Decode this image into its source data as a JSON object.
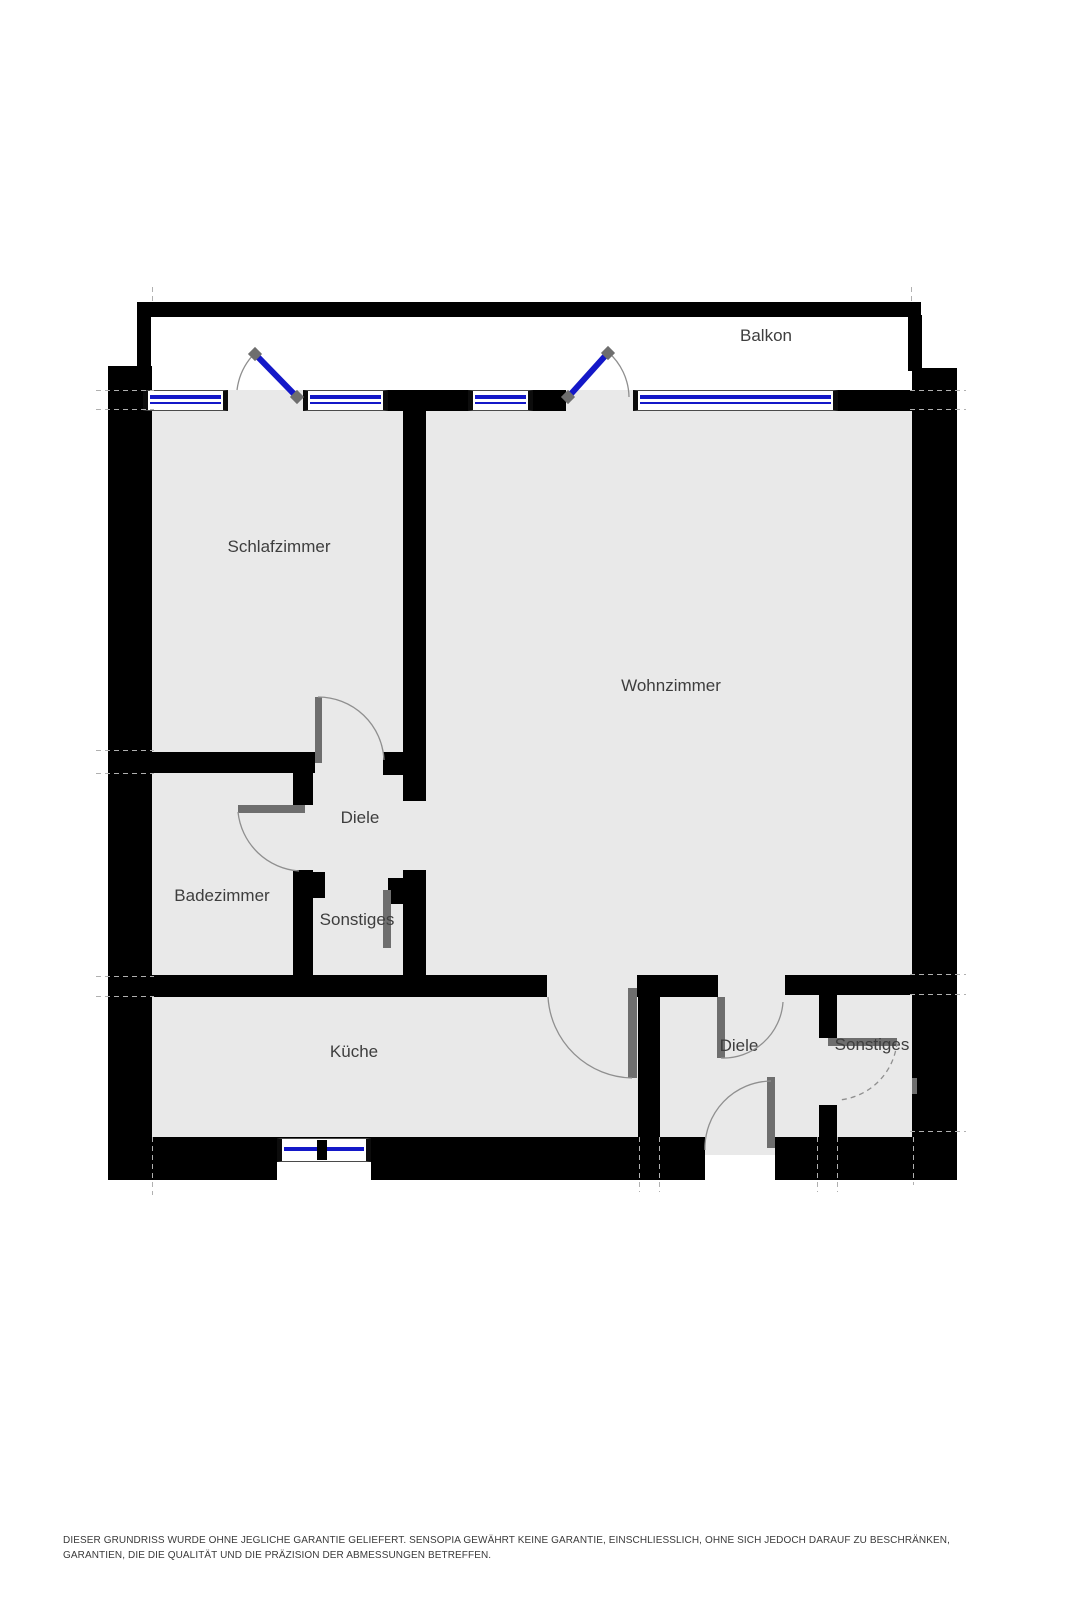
{
  "colors": {
    "wall": "#000000",
    "floor": "#e9e9e9",
    "window": "#1418c8",
    "leaf": "#6e6e6e",
    "arc": "#8f8f8f",
    "dash": "#b0b0b0",
    "label": "#3e3e3e",
    "disclaimer": "#3a3a3a"
  },
  "rooms": [
    {
      "name": "Balkon",
      "x": 766,
      "y": 336
    },
    {
      "name": "Schlafzimmer",
      "x": 279,
      "y": 547
    },
    {
      "name": "Wohnzimmer",
      "x": 671,
      "y": 686
    },
    {
      "name": "Diele",
      "x": 360,
      "y": 818
    },
    {
      "name": "Badezimmer",
      "x": 222,
      "y": 896
    },
    {
      "name": "Sonstiges",
      "x": 357,
      "y": 920
    },
    {
      "name": "Küche",
      "x": 354,
      "y": 1052
    },
    {
      "name": "Diele",
      "x": 739,
      "y": 1046
    },
    {
      "name": "Sonstiges",
      "x": 872,
      "y": 1045
    }
  ],
  "disclaimer": "DIESER GRUNDRISS WURDE OHNE JEGLICHE GARANTIE GELIEFERT. SENSOPIA GEWÄHRT KEINE GARANTIE, EINSCHLIESSLICH, OHNE SICH JEDOCH DARAUF ZU BESCHRÄNKEN, GARANTIEN, DIE DIE QUALITÄT UND DIE PRÄZISION DER ABMESSUNGEN BETREFFEN.",
  "plan": {
    "rects": [
      {
        "x": 151,
        "y": 390,
        "w": 762,
        "h": 747,
        "cls": "floor",
        "name": "apartment-floor"
      },
      {
        "x": 705,
        "y": 1137,
        "w": 70,
        "h": 18,
        "cls": "floor",
        "name": "entrance-floor-tongue"
      },
      {
        "x": 137,
        "y": 302,
        "w": 784,
        "h": 15,
        "cls": "wall",
        "name": "balcony-top-wall"
      },
      {
        "x": 137,
        "y": 315,
        "w": 14,
        "h": 78,
        "cls": "wall",
        "name": "balcony-left-wall"
      },
      {
        "x": 908,
        "y": 315,
        "w": 14,
        "h": 56,
        "cls": "wall",
        "name": "balcony-right-wall"
      },
      {
        "x": 108,
        "y": 366,
        "w": 44,
        "h": 814,
        "cls": "wall",
        "name": "left-outer-wall"
      },
      {
        "x": 912,
        "y": 368,
        "w": 45,
        "h": 812,
        "cls": "wall",
        "name": "right-outer-wall"
      },
      {
        "x": 388,
        "y": 390,
        "w": 80,
        "h": 21,
        "cls": "wall",
        "name": "window-pier-center"
      },
      {
        "x": 533,
        "y": 390,
        "w": 33,
        "h": 21,
        "cls": "wall",
        "name": "window-pier-right"
      },
      {
        "x": 838,
        "y": 390,
        "w": 74,
        "h": 21,
        "cls": "wall",
        "name": "window-pier-far-right"
      },
      {
        "x": 403,
        "y": 408,
        "w": 23,
        "h": 393,
        "cls": "wall",
        "name": "schlafzimmer-wohnzimmer-wall"
      },
      {
        "x": 151,
        "y": 752,
        "w": 164,
        "h": 21,
        "cls": "wall",
        "name": "schlafzimmer-bottom-wall"
      },
      {
        "x": 383,
        "y": 752,
        "w": 20,
        "h": 23,
        "cls": "wall",
        "name": "schlafzimmer-door-stub"
      },
      {
        "x": 293,
        "y": 773,
        "w": 20,
        "h": 32,
        "cls": "wall",
        "name": "badezimmer-right-wall-upper"
      },
      {
        "x": 293,
        "y": 870,
        "w": 20,
        "h": 107,
        "cls": "wall",
        "name": "badezimmer-right-wall-lower"
      },
      {
        "x": 313,
        "y": 872,
        "w": 12,
        "h": 26,
        "cls": "wall",
        "name": "badezimmer-door-pier"
      },
      {
        "x": 403,
        "y": 870,
        "w": 23,
        "h": 107,
        "cls": "wall",
        "name": "diele-wall-lower"
      },
      {
        "x": 388,
        "y": 878,
        "w": 15,
        "h": 26,
        "cls": "wall",
        "name": "sonstiges-door-pier"
      },
      {
        "x": 108,
        "y": 975,
        "w": 439,
        "h": 22,
        "cls": "wall",
        "name": "kueche-top-wall"
      },
      {
        "x": 638,
        "y": 975,
        "w": 22,
        "h": 162,
        "cls": "wall",
        "name": "lower-diele-left-wall"
      },
      {
        "x": 637,
        "y": 975,
        "w": 81,
        "h": 22,
        "cls": "wall",
        "name": "lower-diele-top-wall"
      },
      {
        "x": 785,
        "y": 975,
        "w": 130,
        "h": 20,
        "cls": "wall",
        "name": "lower-sonstiges-top-wall"
      },
      {
        "x": 819,
        "y": 995,
        "w": 18,
        "h": 43,
        "cls": "wall",
        "name": "separator-wall-upper"
      },
      {
        "x": 819,
        "y": 1105,
        "w": 18,
        "h": 32,
        "cls": "wall",
        "name": "separator-wall-lower"
      },
      {
        "x": 108,
        "y": 1137,
        "w": 597,
        "h": 43,
        "cls": "wall",
        "name": "bottom-wall-left"
      },
      {
        "x": 775,
        "y": 1137,
        "w": 182,
        "h": 43,
        "cls": "wall",
        "name": "bottom-wall-right"
      },
      {
        "x": 277,
        "y": 1162,
        "w": 94,
        "h": 18,
        "cls": "white",
        "name": "kueche-window-recess"
      },
      {
        "x": 143,
        "y": 390,
        "w": 85,
        "h": 21,
        "cls": "window",
        "name": "window-schlafzimmer-left"
      },
      {
        "x": 303,
        "y": 390,
        "w": 85,
        "h": 21,
        "cls": "window",
        "name": "window-schlafzimmer-right"
      },
      {
        "x": 468,
        "y": 390,
        "w": 65,
        "h": 21,
        "cls": "window",
        "name": "window-wohnzimmer-left"
      },
      {
        "x": 633,
        "y": 390,
        "w": 205,
        "h": 21,
        "cls": "window",
        "name": "window-wohnzimmer-right"
      },
      {
        "x": 277,
        "y": 1138,
        "w": 94,
        "h": 24,
        "cls": "window window-k",
        "name": "window-kueche"
      },
      {
        "x": 317,
        "y": 1140,
        "w": 10,
        "h": 20,
        "cls": "wall",
        "name": "kueche-window-mullion"
      },
      {
        "x": 315,
        "y": 697,
        "w": 7,
        "h": 66,
        "cls": "leaf",
        "name": "schlafzimmer-door-leaf"
      },
      {
        "x": 238,
        "y": 805,
        "w": 67,
        "h": 8,
        "cls": "leaf",
        "name": "badezimmer-door-leaf"
      },
      {
        "x": 383,
        "y": 890,
        "w": 8,
        "h": 58,
        "cls": "leaf",
        "name": "sonstiges-upper-door-leaf"
      },
      {
        "x": 628,
        "y": 988,
        "w": 9,
        "h": 90,
        "cls": "leaf",
        "name": "kueche-door-leaf"
      },
      {
        "x": 717,
        "y": 997,
        "w": 8,
        "h": 61,
        "cls": "leaf",
        "name": "lower-diele-door-leaf"
      },
      {
        "x": 767,
        "y": 1077,
        "w": 8,
        "h": 71,
        "cls": "leaf",
        "name": "entrance-door-leaf"
      },
      {
        "x": 828,
        "y": 1038,
        "w": 69,
        "h": 8,
        "cls": "leaf",
        "name": "lower-sonstiges-door-leaf"
      },
      {
        "x": 912,
        "y": 1078,
        "w": 5,
        "h": 16,
        "cls": "leaf",
        "name": "door-mark"
      },
      {
        "x": 96,
        "y": 390,
        "w": 58,
        "h": 1,
        "cls": "hdash",
        "name": "dash-line"
      },
      {
        "x": 96,
        "y": 409,
        "w": 58,
        "h": 1,
        "cls": "hdash",
        "name": "dash-line"
      },
      {
        "x": 96,
        "y": 750,
        "w": 58,
        "h": 1,
        "cls": "hdash",
        "name": "dash-line"
      },
      {
        "x": 96,
        "y": 773,
        "w": 58,
        "h": 1,
        "cls": "hdash",
        "name": "dash-line"
      },
      {
        "x": 96,
        "y": 976,
        "w": 58,
        "h": 1,
        "cls": "hdash",
        "name": "dash-line"
      },
      {
        "x": 96,
        "y": 996,
        "w": 58,
        "h": 1,
        "cls": "hdash",
        "name": "dash-line"
      },
      {
        "x": 910,
        "y": 390,
        "w": 56,
        "h": 1,
        "cls": "hdash",
        "name": "dash-line"
      },
      {
        "x": 910,
        "y": 409,
        "w": 56,
        "h": 1,
        "cls": "hdash",
        "name": "dash-line"
      },
      {
        "x": 910,
        "y": 974,
        "w": 56,
        "h": 1,
        "cls": "hdash",
        "name": "dash-line"
      },
      {
        "x": 910,
        "y": 994,
        "w": 56,
        "h": 1,
        "cls": "hdash",
        "name": "dash-line"
      },
      {
        "x": 910,
        "y": 1131,
        "w": 56,
        "h": 1,
        "cls": "hdash",
        "name": "dash-line"
      },
      {
        "x": 152,
        "y": 287,
        "w": 1,
        "h": 15,
        "cls": "vdash",
        "name": "dash-line"
      },
      {
        "x": 911,
        "y": 287,
        "w": 1,
        "h": 15,
        "cls": "vdash",
        "name": "dash-line"
      },
      {
        "x": 152,
        "y": 1137,
        "w": 1,
        "h": 58,
        "cls": "vdash",
        "name": "dash-line"
      },
      {
        "x": 639,
        "y": 1137,
        "w": 1,
        "h": 55,
        "cls": "vdash",
        "name": "dash-line"
      },
      {
        "x": 659,
        "y": 1137,
        "w": 1,
        "h": 55,
        "cls": "vdash",
        "name": "dash-line"
      },
      {
        "x": 817,
        "y": 1137,
        "w": 1,
        "h": 55,
        "cls": "vdash",
        "name": "dash-line"
      },
      {
        "x": 837,
        "y": 1137,
        "w": 1,
        "h": 55,
        "cls": "vdash",
        "name": "dash-line"
      },
      {
        "x": 913,
        "y": 1137,
        "w": 1,
        "h": 48,
        "cls": "vdash",
        "name": "dash-line"
      }
    ],
    "arcs": [
      {
        "d": "M 237 390 A 64 64 0 0 1 255 353",
        "name": "balcony-door-left-swing"
      },
      {
        "d": "M 608 352 A 61 61 0 0 1 629 397",
        "name": "balcony-door-right-swing"
      },
      {
        "d": "M 318 697 A 66 66 0 0 1 384 760",
        "name": "schlafzimmer-door-swing"
      },
      {
        "d": "M 238 812 A 66 66 0 0 0 299 871",
        "name": "badezimmer-door-swing"
      },
      {
        "d": "M 632 1078 A 86 86 0 0 1 548 997",
        "name": "kueche-door-swing"
      },
      {
        "d": "M 721 1058 A 60 60 0 0 0 783 1002",
        "name": "lower-diele-door-swing"
      },
      {
        "d": "M 771 1081 A 67 67 0 0 0 705 1150",
        "name": "entrance-door-swing"
      },
      {
        "d": "M 897 1042 A 64 64 0 0 1 839 1100",
        "cls": "arc dashed",
        "name": "lower-sonstiges-door-swing"
      }
    ],
    "door_lines": [
      {
        "x1": 295,
        "y1": 395,
        "x2": 257,
        "y2": 356,
        "name": "balcony-door-left-leaf"
      },
      {
        "x1": 570,
        "y1": 395,
        "x2": 606,
        "y2": 355,
        "name": "balcony-door-right-leaf"
      }
    ],
    "door_squares": [
      {
        "x": 297,
        "y": 397,
        "name": "door-hinge"
      },
      {
        "x": 255,
        "y": 354,
        "name": "door-hinge"
      },
      {
        "x": 568,
        "y": 397,
        "name": "door-hinge"
      },
      {
        "x": 608,
        "y": 353,
        "name": "door-hinge"
      }
    ]
  }
}
